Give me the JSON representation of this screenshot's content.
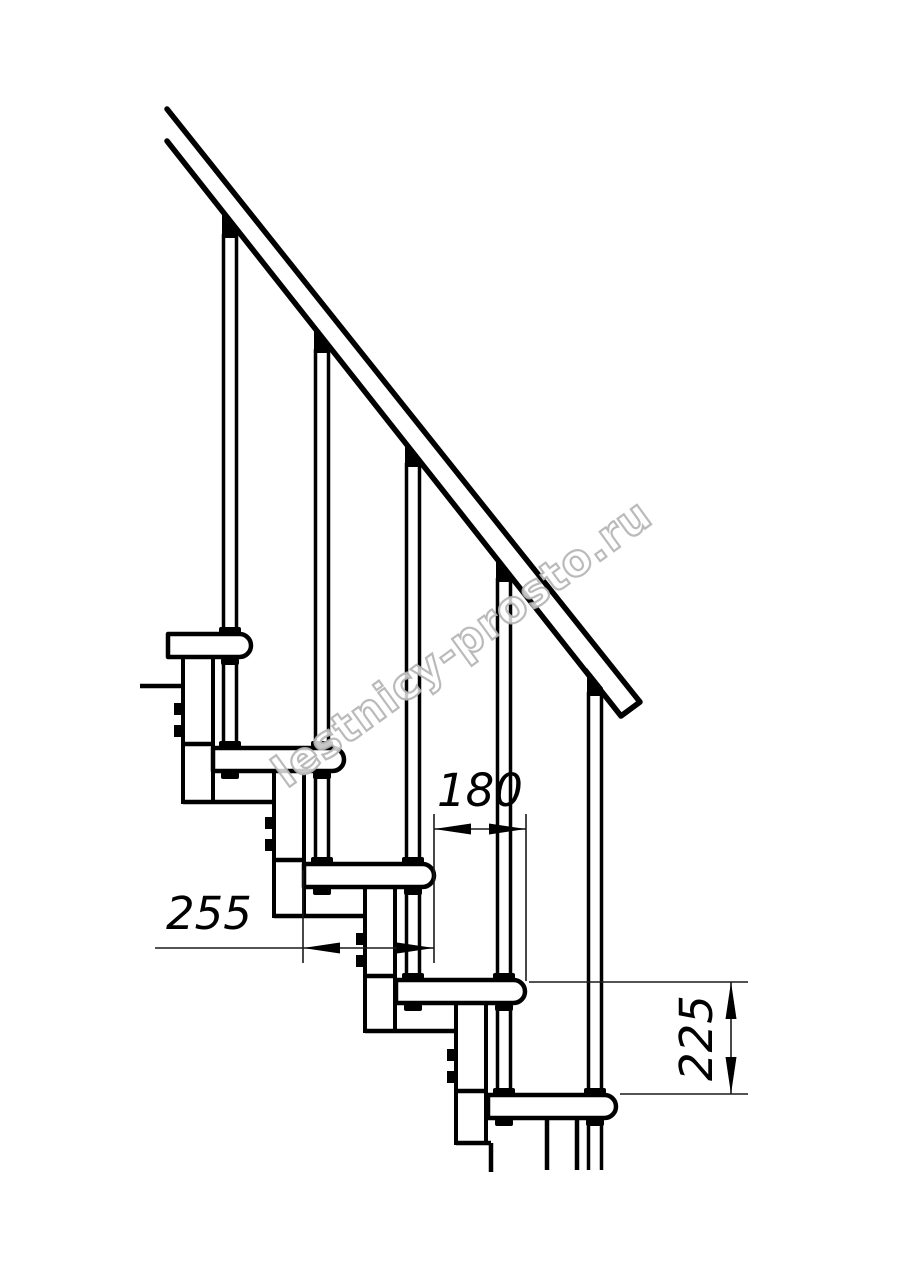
{
  "drawing": {
    "type": "modular-staircase-side-view",
    "dimensions": {
      "step_run_mm": "180",
      "tread_depth_mm": "255",
      "step_rise_mm": "225"
    }
  },
  "watermark": {
    "text": "lestnicy-prosto.ru"
  },
  "colors": {
    "line": "#000000",
    "watermark": "#b3b3b3",
    "background": "#ffffff"
  }
}
